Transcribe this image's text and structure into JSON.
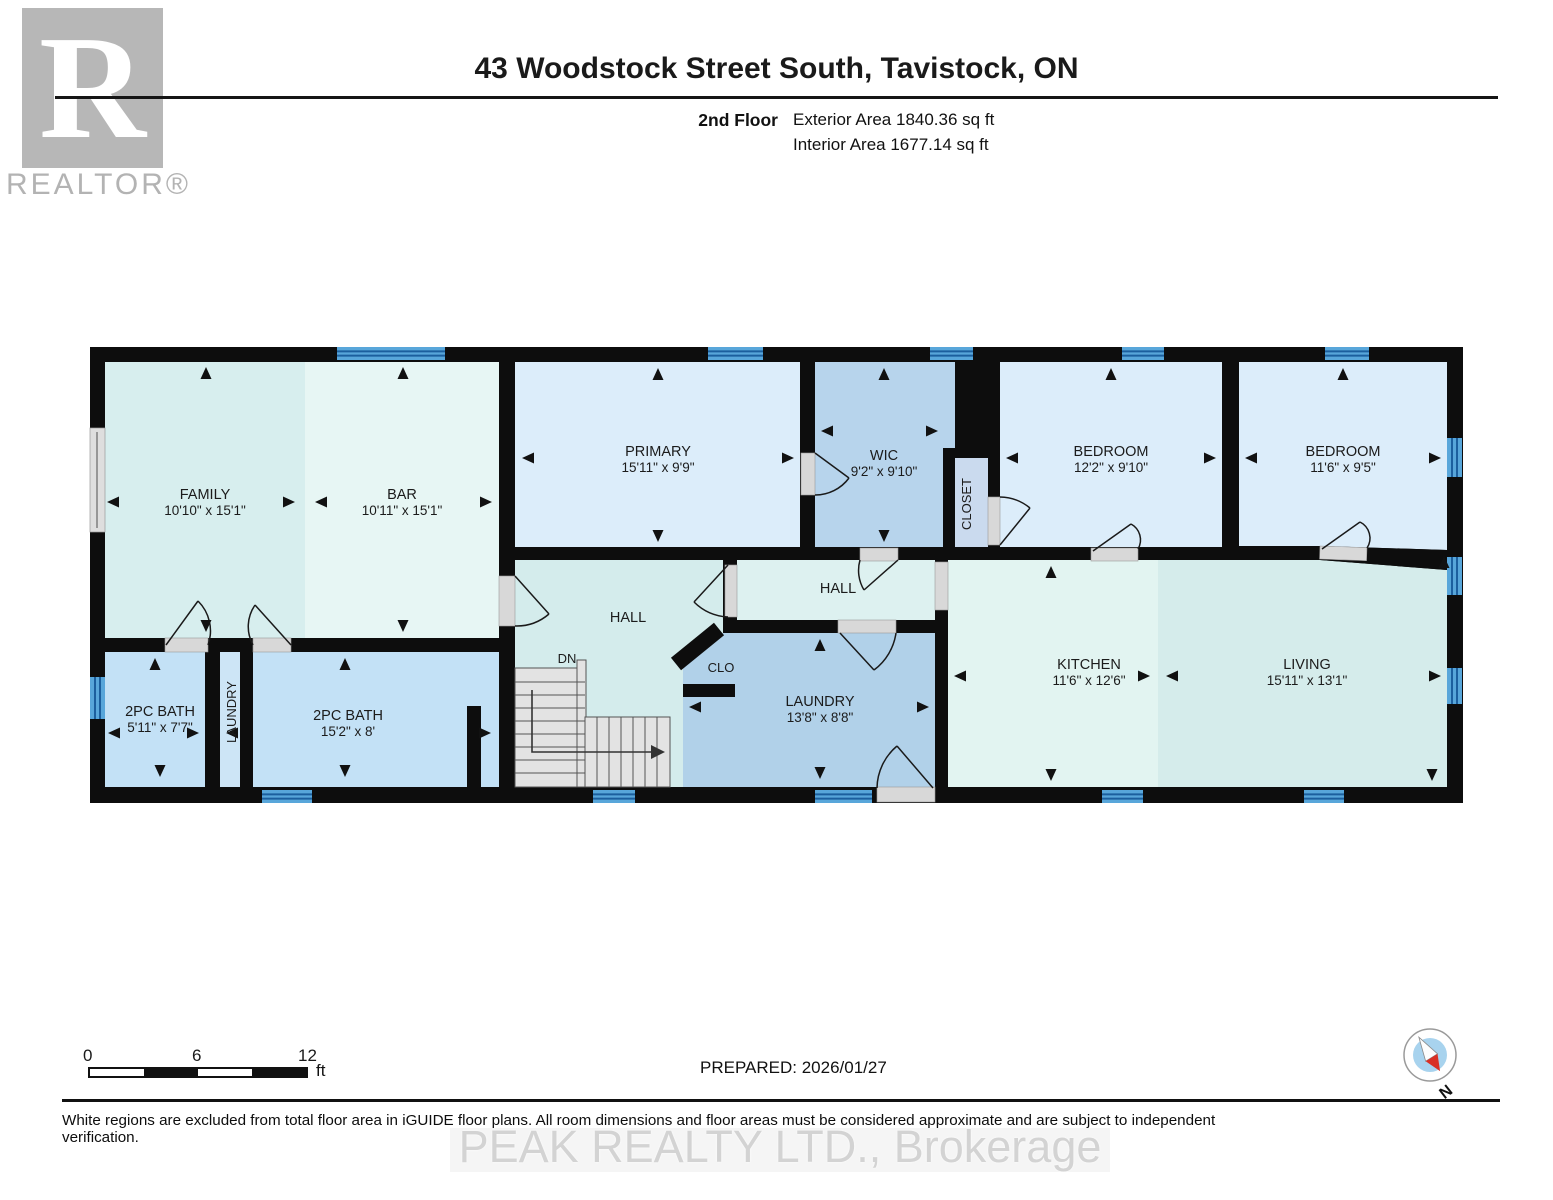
{
  "header": {
    "logo_letter": "R",
    "logo_text": "REALTOR®",
    "title": "43 Woodstock Street South, Tavistock, ON",
    "floor_label": "2nd Floor",
    "exterior_area": "Exterior Area 1840.36 sq ft",
    "interior_area": "Interior Area 1677.14 sq ft"
  },
  "rooms": {
    "family": {
      "label": "FAMILY",
      "dims": "10'10\" x 15'1\""
    },
    "bar": {
      "label": "BAR",
      "dims": "10'11\" x 15'1\""
    },
    "primary": {
      "label": "PRIMARY",
      "dims": "15'11\" x 9'9\""
    },
    "wic": {
      "label": "WIC",
      "dims": "9'2\" x 9'10\""
    },
    "closet": {
      "label": "CLOSET"
    },
    "bedroom1": {
      "label": "BEDROOM",
      "dims": "12'2\" x 9'10\""
    },
    "bedroom2": {
      "label": "BEDROOM",
      "dims": "11'6\" x 9'5\""
    },
    "hall1": {
      "label": "HALL"
    },
    "hall2": {
      "label": "HALL"
    },
    "dn": {
      "label": "DN"
    },
    "clo": {
      "label": "CLO"
    },
    "laundry_room": {
      "label": "LAUNDRY",
      "dims": "13'8\" x 8'8\""
    },
    "laundry_closet": {
      "label": "LAUNDRY"
    },
    "bath_small": {
      "label": "2PC BATH",
      "dims": "5'11\" x 7'7\""
    },
    "bath_big": {
      "label": "2PC BATH",
      "dims": "15'2\" x 8'"
    },
    "kitchen": {
      "label": "KITCHEN",
      "dims": "11'6\" x 12'6\""
    },
    "living": {
      "label": "LIVING",
      "dims": "15'11\" x 13'1\""
    }
  },
  "scale_bar": {
    "tick0": "0",
    "tick6": "6",
    "tick12": "12",
    "unit": "ft"
  },
  "footer": {
    "prepared": "PREPARED: 2026/01/27",
    "disclaimer": "White regions are excluded from total floor area in iGUIDE floor plans. All room dimensions and floor areas must be considered approximate and are subject to independent verification.",
    "watermark": "PEAK REALTY LTD., Brokerage",
    "compass_label": "N"
  },
  "colors": {
    "wall": "#0d0d0d",
    "window_blue": "#58a6da",
    "window_line": "#1c5f9e",
    "compass_red": "#d93025"
  }
}
